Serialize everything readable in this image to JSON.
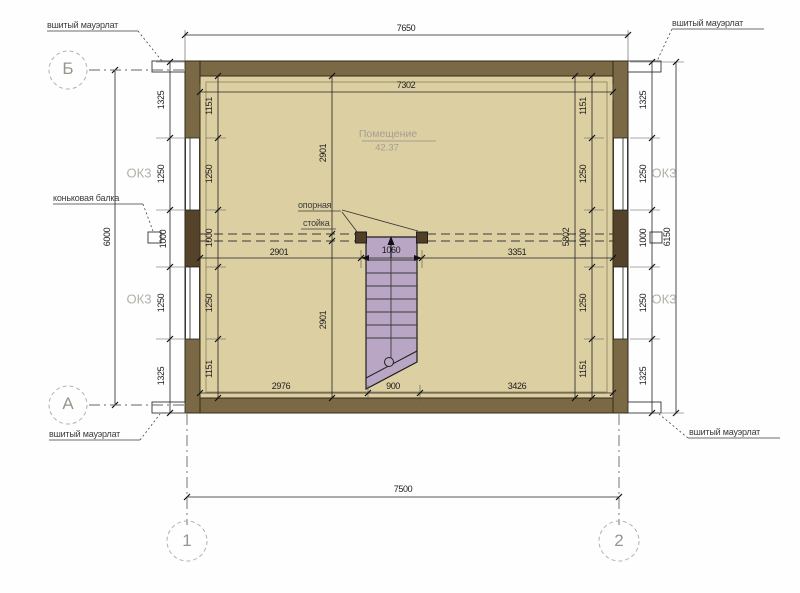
{
  "title": "attic floor plan",
  "labels": {
    "mauerlat_tl": "вшитый мауэрлат",
    "mauerlat_tr": "вшитый мауэрлат",
    "mauerlat_bl": "вшитый мауэрлат",
    "mauerlat_br": "вшитый мауэрлат",
    "ridge_beam": "коньковая балка",
    "support_post_line1": "опорная",
    "support_post_line2": "стойка",
    "room_name": "Помещение",
    "room_area": "42.37",
    "window_mark": "ОК3"
  },
  "axes": {
    "row_top": "Б",
    "row_bottom": "А",
    "col_left": "1",
    "col_right": "2"
  },
  "dims": {
    "top_outer": "7650",
    "top_inner": "7302",
    "mid_left": "2901",
    "mid_stairs": "1060",
    "mid_right": "3351",
    "bottom_left": "2976",
    "bottom_stairs": "900",
    "bottom_right": "3426",
    "bottom_outer": "7500",
    "left_overall": "6000",
    "right_overall": "6150",
    "inner_height": "5802",
    "vert_upper": "2901",
    "vert_lower": "2901",
    "left_outer_chain": [
      "1325",
      "1250",
      "1000",
      "1250",
      "1325"
    ],
    "left_inner_chain": [
      "1151",
      "1250",
      "1000",
      "1250",
      "1151"
    ],
    "right_inner_chain": [
      "1151",
      "1250",
      "1000",
      "1250",
      "1151"
    ],
    "right_outer_chain": [
      "1325",
      "1250",
      "1000",
      "1250",
      "1325"
    ]
  },
  "colors": {
    "wall": "#7b6946",
    "wall_ridge_segment": "#54432a",
    "floor": "#dccfa2",
    "stairs": "#b8a6c4",
    "support_post": "#503f26",
    "annotation_gray": "#a29e95"
  }
}
